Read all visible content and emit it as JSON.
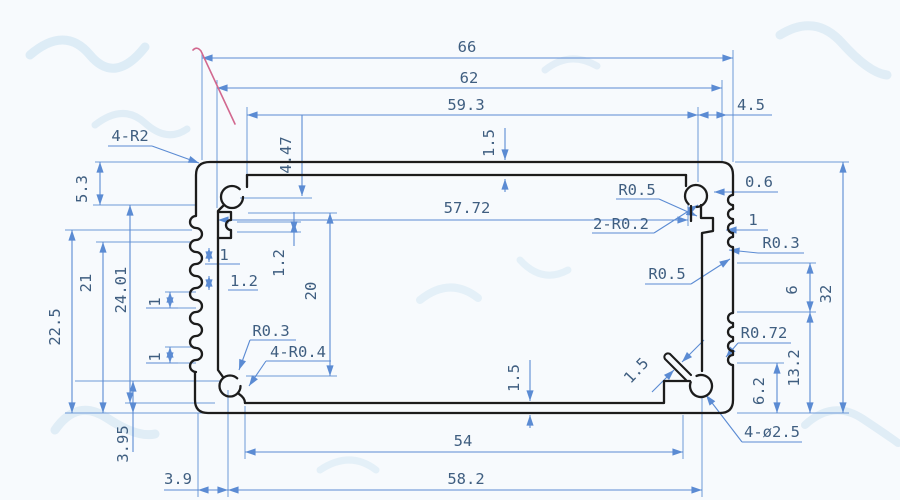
{
  "drawing": {
    "title": "Aluminum extrusion enclosure profile cross-section, dimensioned CAD drawing",
    "units": "mm",
    "colors": {
      "paper": "#f7fafd",
      "dimension_lines": "#5b8bd3",
      "dimension_text": "#3f5e80",
      "profile_outline": "#1c1c1c",
      "stray_pen_mark": "#d2688f",
      "watermark": "#c9e0f0"
    }
  },
  "dims": {
    "overall_width": "66",
    "width_62": "62",
    "width_59_3": "59.3",
    "offset_4_5": "4.5",
    "depth_4_47": "4.47",
    "wall_top_1_5": "1.5",
    "corner_radius_4_r2": "4-R2",
    "h_5_3": "5.3",
    "h_22_5": "22.5",
    "h_21": "21",
    "h_24_01": "24.01",
    "h_3_95": "3.95",
    "w_3_9": "3.9",
    "w_58_2": "58.2",
    "w_54": "54",
    "wall_bottom_1_5": "1.5",
    "fin_pitch_1a": "1",
    "fin_width_1_2": "1.2",
    "fin_pitch_1b": "1",
    "fin_pitch_1c": "1",
    "slot_width_1_2": "1.2",
    "h_20": "20",
    "w_57_72": "57.72",
    "radius_r0_5_top": "R0.5",
    "radius_2_r0_2": "2-R0.2",
    "t_0_6": "0.6",
    "groove_depth_1": "1",
    "radius_r0_3_right": "R0.3",
    "radius_r0_5_mid": "R0.5",
    "h_6": "6",
    "h_32": "32",
    "radius_r0_72": "R0.72",
    "h_13_2": "13.2",
    "h_6_2": "6.2",
    "screw_holes_4_d2_5": "4-ø2.5",
    "slot_gap_1_5": "1.5",
    "radius_r0_3_left": "R0.3",
    "radius_4_r0_4": "4-R0.4"
  }
}
